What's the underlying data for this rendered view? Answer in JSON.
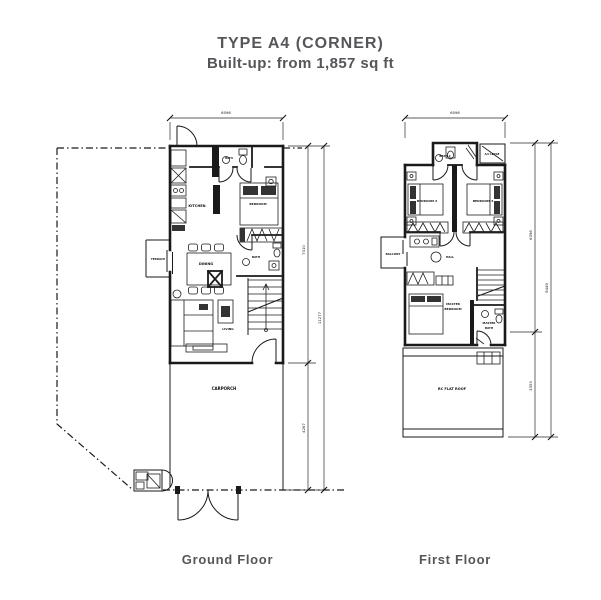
{
  "header": {
    "title": "TYPE A4 (CORNER)",
    "subtitle": "Built-up: from 1,857 sq ft"
  },
  "ground_floor": {
    "caption": "Ground Floor",
    "rooms": {
      "terrace": "TERRACE",
      "kitchen": "KITCHEN",
      "dining": "DINING",
      "living": "LIVING",
      "bath_top": "BATH",
      "bedroom": "BEDROOM",
      "bath_lower": "BATH",
      "carporch": "CARPORCH"
    },
    "dimensions": {
      "width": "6096",
      "depth_upper": "7010",
      "depth_lower": "4267",
      "depth_total": "11277"
    }
  },
  "first_floor": {
    "caption": "First Floor",
    "rooms": {
      "bath2": "BATH 2",
      "bedroom2": "BEDROOM 2",
      "bedroom3": "BEDROOM 3",
      "balcony": "BALCONY",
      "hall": "HALL",
      "master_bedroom_1": "MASTER",
      "master_bedroom_2": "BEDROOM",
      "master_bath_1": "MASTER",
      "master_bath_2": "BATH",
      "flat_roof": "RC FLAT ROOF",
      "ac_ledge": "A/C LEDGE"
    },
    "dimensions": {
      "width": "6096",
      "depth_upper": "6096",
      "depth_lower": "3353",
      "depth_total": "9449"
    }
  },
  "colors": {
    "line": "#1a1a1a",
    "text": "#55565a"
  }
}
